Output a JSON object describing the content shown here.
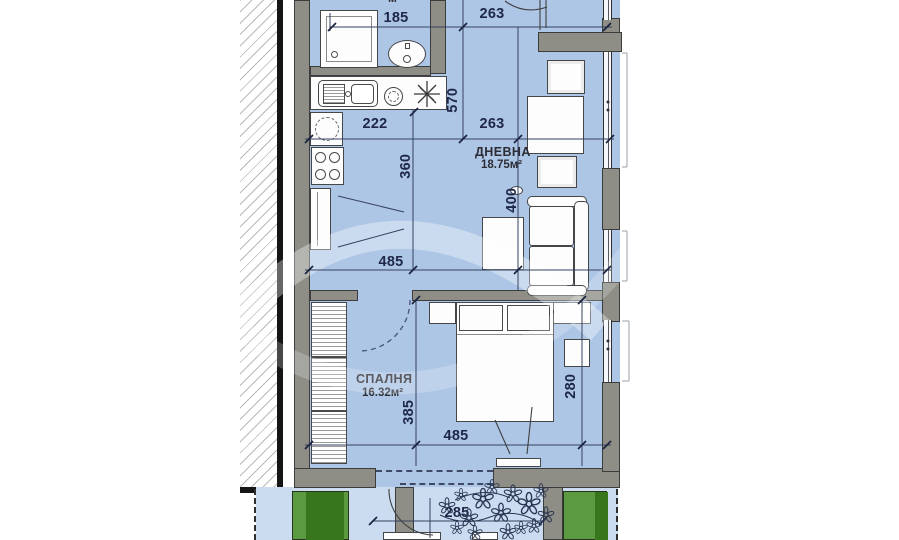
{
  "plan_title": "apartment-floor-plan",
  "rooms": [
    {
      "id": "living",
      "name": "ДНЕВНА",
      "area": "18.75м²"
    },
    {
      "id": "bedroom",
      "name": "СПАЛНЯ",
      "area": "16.32м²"
    }
  ],
  "clipped_top_area_label": "м²",
  "dimensions": [
    {
      "id": "bath-width",
      "value": "185",
      "orientation": "horizontal"
    },
    {
      "id": "entry-width",
      "value": "263",
      "orientation": "horizontal"
    },
    {
      "id": "hall-depth",
      "value": "570",
      "orientation": "vertical"
    },
    {
      "id": "kitchen-width",
      "value": "222",
      "orientation": "horizontal"
    },
    {
      "id": "living-top-width",
      "value": "263",
      "orientation": "horizontal"
    },
    {
      "id": "kitchen-depth",
      "value": "360",
      "orientation": "vertical"
    },
    {
      "id": "dining-depth",
      "value": "400",
      "orientation": "vertical"
    },
    {
      "id": "living-width",
      "value": "485",
      "orientation": "horizontal"
    },
    {
      "id": "bedroom-depth",
      "value": "385",
      "orientation": "vertical"
    },
    {
      "id": "bedroom-width",
      "value": "485",
      "orientation": "horizontal"
    },
    {
      "id": "bedroom-right-depth",
      "value": "280",
      "orientation": "vertical"
    },
    {
      "id": "terrace-width",
      "value": "285",
      "orientation": "horizontal"
    }
  ],
  "colors": {
    "floor": "#aec6e6",
    "terrace": "#cbdcf1",
    "wall": "#8e8e86",
    "planter_light": "#5b9a40",
    "planter_dark": "#37761d",
    "dim_text": "#1e2747",
    "line": "#35415f"
  }
}
